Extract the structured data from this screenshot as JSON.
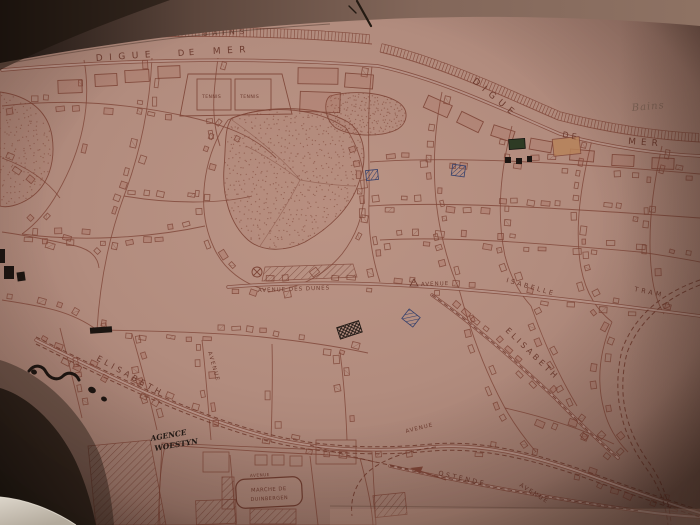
{
  "labels": {
    "bains": "BAINS",
    "digue_de_mer_left": {
      "digue": "DIGUE",
      "de": "DE",
      "mer": "MER"
    },
    "digue_right": "DIGUE",
    "de_mer_right": {
      "de": "DE",
      "mer": "MER"
    },
    "bains_script": "Bains",
    "tennis_left": "TENNIS",
    "tennis_right": "TENNIS",
    "avenue_des_dunes": "AVENUE DES DUNES",
    "avenue_center": "AVENUE",
    "isabelle": "ISABELLE",
    "tram": "TRAM",
    "elisabeth_left": "ELISABETH",
    "elisabeth_right": "ELISABETH",
    "avenue_vertical": "AVENUE",
    "avenue_mid": "AVENUE",
    "agence_line1": "AGENCE",
    "agence_line2": "WOESTYN",
    "marche_line1": "MARCHE DE",
    "marche_line2": "DUINBERGEN",
    "avenue_market": "AVENUE",
    "ostende": "OSTENDE",
    "avenue_southeast": "AVENUE"
  },
  "colors": {
    "paper": "#b28c7e",
    "ink": "#7e4537",
    "label_ink": "#6a382c",
    "black_ink": "#1c1511",
    "blue_pencil": "#35406b",
    "green_pencil": "#2e3b24",
    "tan_highlight": "#b8835a"
  }
}
